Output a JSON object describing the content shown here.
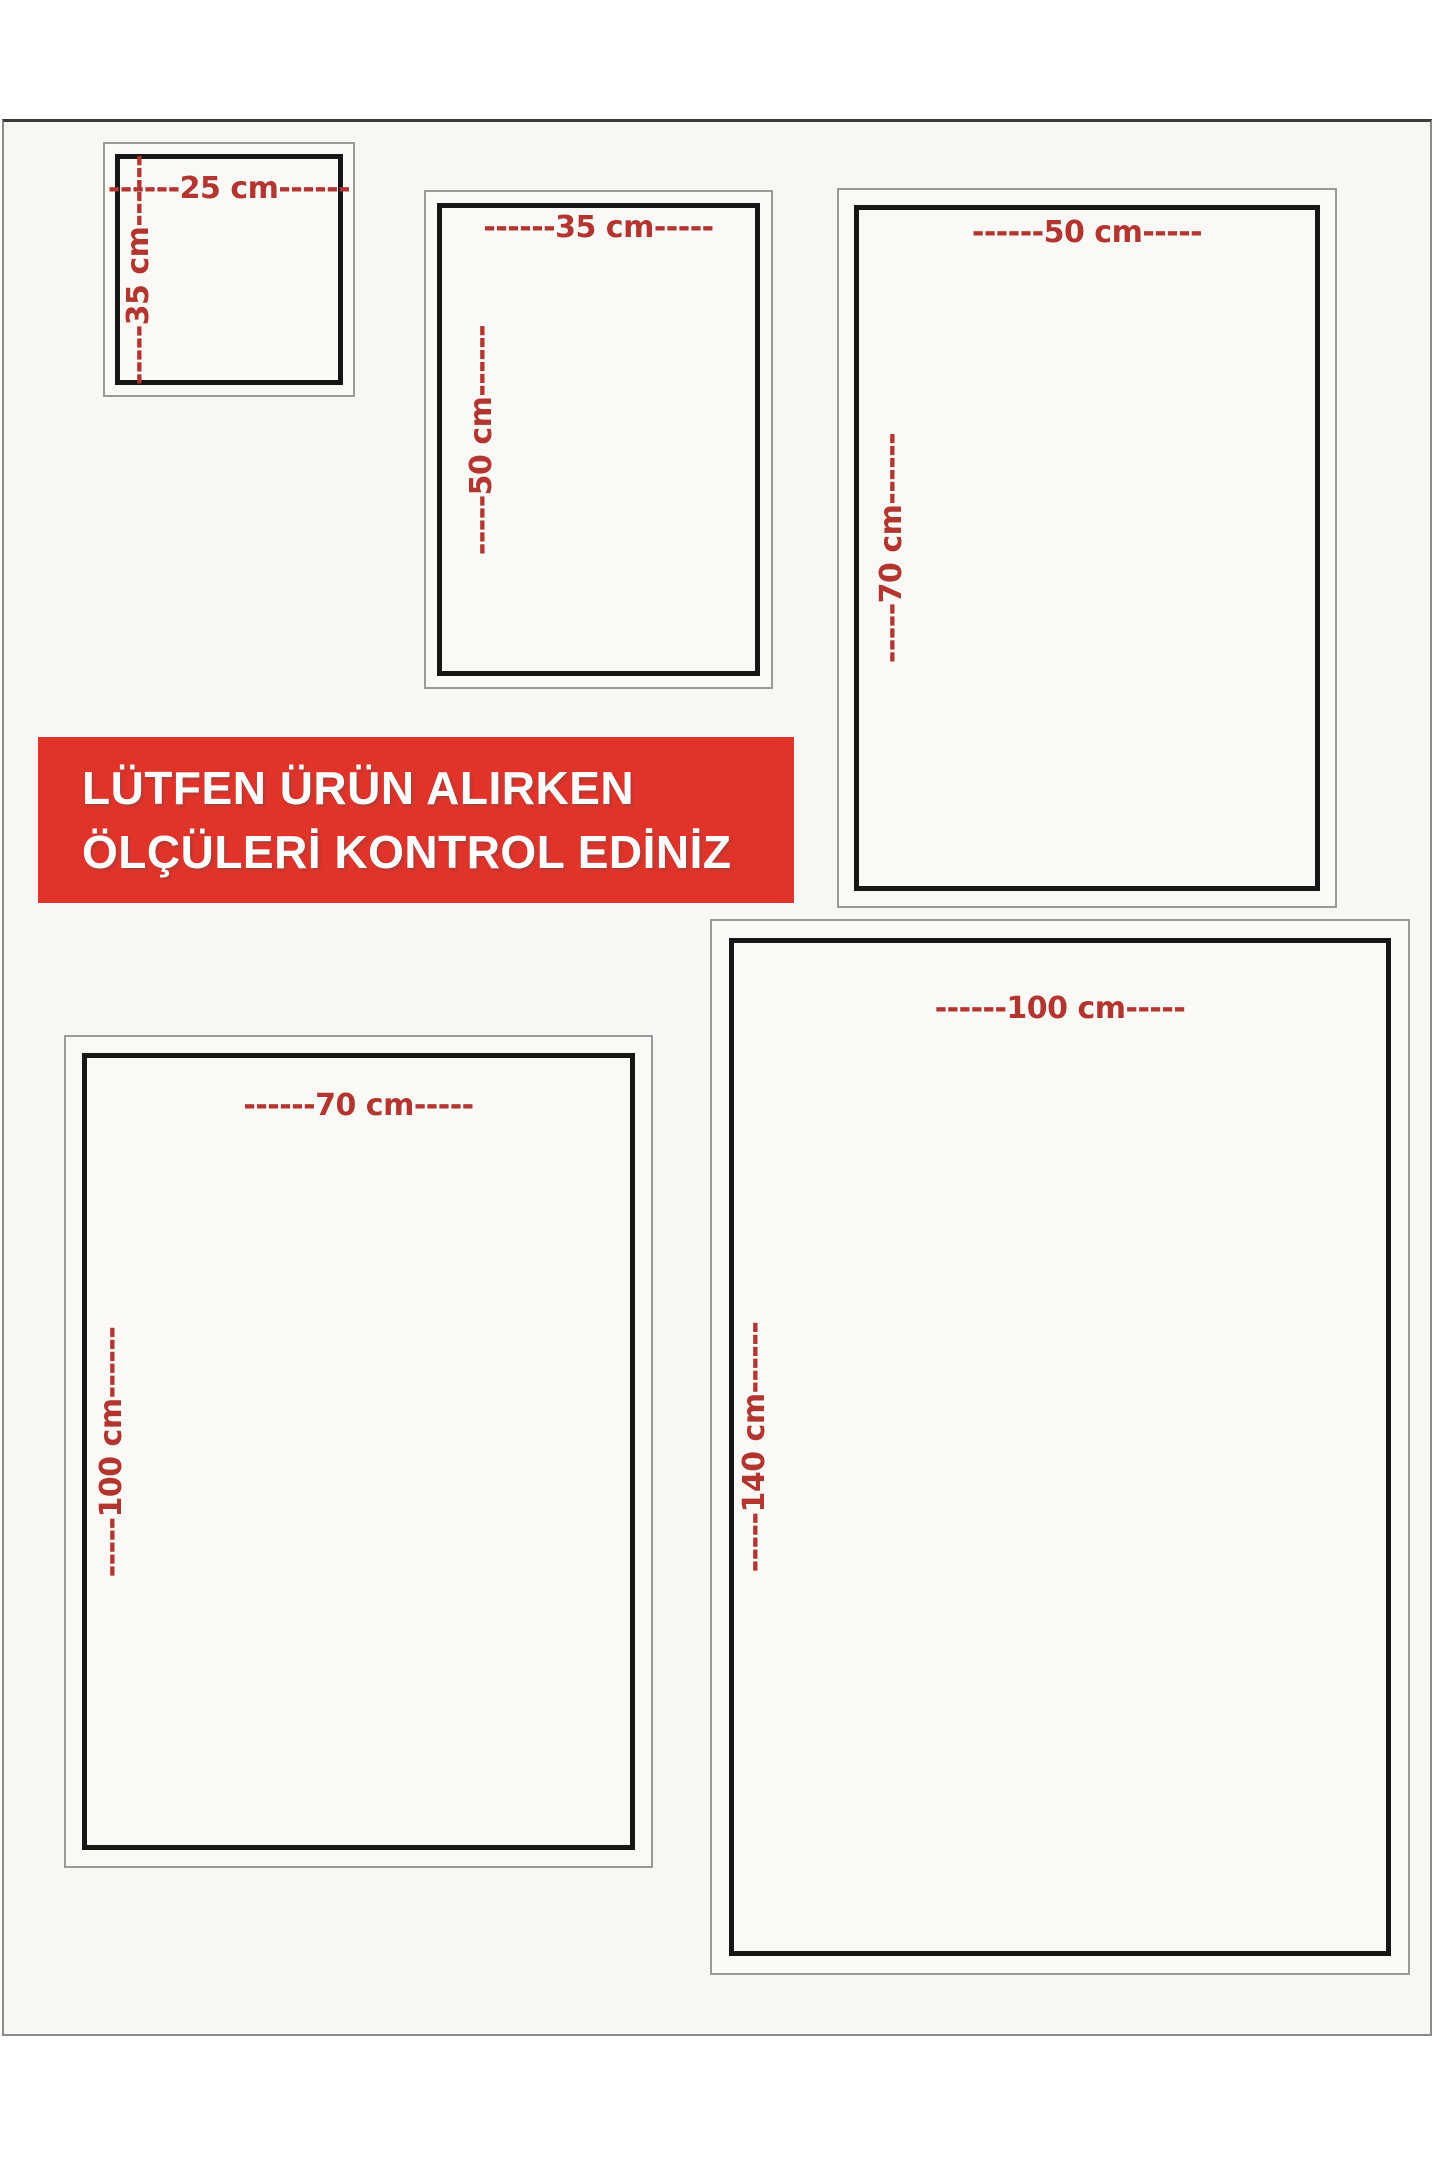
{
  "colors": {
    "dimension_text": "#b23530",
    "banner_background": "#e0332a",
    "banner_text": "#ffffff",
    "frame_black": "#161616",
    "frame_gray": "#9a9a9a"
  },
  "banner": {
    "line1": "LÜTFEN ÜRÜN ALIRKEN",
    "line2": "ÖLÇÜLERİ KONTROL EDİNİZ"
  },
  "size_boxes": [
    {
      "id": "25x35",
      "width_cm": 25,
      "height_cm": 35,
      "width_label": "------25 cm------",
      "height_label": "-----35 cm------"
    },
    {
      "id": "35x50",
      "width_cm": 35,
      "height_cm": 50,
      "width_label": "------35 cm-----",
      "height_label": "-----50 cm------"
    },
    {
      "id": "50x70",
      "width_cm": 50,
      "height_cm": 70,
      "width_label": "------50 cm-----",
      "height_label": "-----70 cm------"
    },
    {
      "id": "70x100",
      "width_cm": 70,
      "height_cm": 100,
      "width_label": "------70 cm-----",
      "height_label": "-----100 cm------"
    },
    {
      "id": "100x140",
      "width_cm": 100,
      "height_cm": 140,
      "width_label": "------100 cm-----",
      "height_label": "-----140 cm------"
    }
  ]
}
